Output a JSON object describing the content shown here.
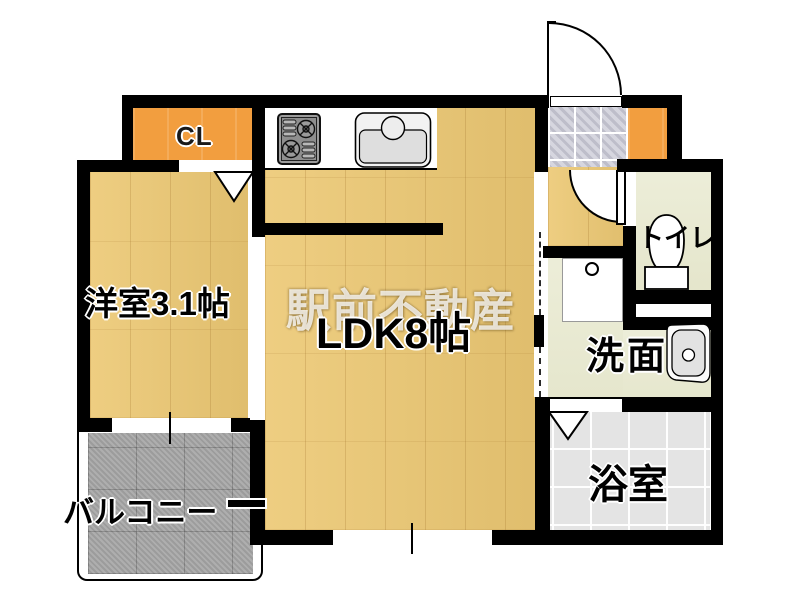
{
  "type": "apartment-floor-plan",
  "watermark": "駅前不動産",
  "rooms": {
    "closet": {
      "label": "CL"
    },
    "western_room": {
      "label": "洋室3.1帖"
    },
    "ldk": {
      "label": "LDK8帖"
    },
    "toilet": {
      "label": "トイレ"
    },
    "washroom": {
      "label": "洗面"
    },
    "bathroom": {
      "label": "浴室"
    },
    "balcony": {
      "label": "バルコニー"
    }
  },
  "icons": {
    "entrance_door": "entrance-swing-door",
    "toilet_door": "toilet-swing-door",
    "closet_door_mark": "triangle-door-marker",
    "bath_door_mark": "triangle-door-marker",
    "stove": "gas-stove",
    "sink": "kitchen-sink",
    "toilet_bowl": "toilet-bowl",
    "washbasin": "washbasin",
    "washer_pan": "washing-machine-pan"
  },
  "colors": {
    "wall": "#000000",
    "wood_floor": "#ecc873",
    "closet_orange": "#f29e3f",
    "entrance_tile": "#d6d6df",
    "sanitary_floor": "#eaebd3",
    "bathroom_floor": "#e4e4e4",
    "balcony_gray": "#a8a8a8",
    "watermark_white": "#ffffff"
  }
}
